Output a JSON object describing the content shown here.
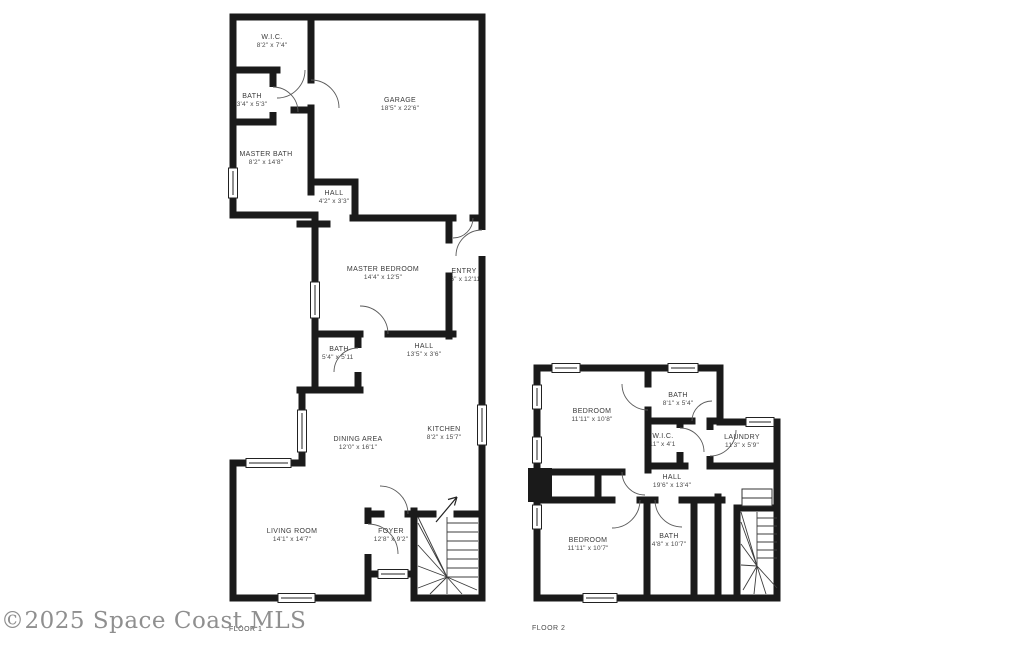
{
  "watermark": "©2025 Space Coast MLS",
  "colors": {
    "wall": "#1a1a1a",
    "label_text": "#3a3a3a",
    "watermark_gray": "#8f8f8f"
  },
  "floors": [
    {
      "label": "FLOOR 1",
      "rooms": [
        {
          "name": "W.I.C.",
          "dims": "8'2\" x 7'4\""
        },
        {
          "name": "BATH",
          "dims": "3'4\" x 5'3\""
        },
        {
          "name": "MASTER BATH",
          "dims": "8'2\" x 14'8\""
        },
        {
          "name": "GARAGE",
          "dims": "18'5\" x 22'6\""
        },
        {
          "name": "HALL",
          "dims": "4'2\" x 3'3\""
        },
        {
          "name": "MASTER BEDROOM",
          "dims": "14'4\" x 12'5\""
        },
        {
          "name": "ENTRY",
          "dims": "3'6\" x 12'11\""
        },
        {
          "name": "BATH",
          "dims": "5'4\" x 5'11\""
        },
        {
          "name": "HALL",
          "dims": "13'5\" x 3'6\""
        },
        {
          "name": "KITCHEN",
          "dims": "8'2\" x 15'7\""
        },
        {
          "name": "DINING AREA",
          "dims": "12'0\" x 16'1\""
        },
        {
          "name": "LIVING ROOM",
          "dims": "14'1\" x 14'7\""
        },
        {
          "name": "FOYER",
          "dims": "12'8\" x 9'2\""
        }
      ]
    },
    {
      "label": "FLOOR 2",
      "rooms": [
        {
          "name": "BEDROOM",
          "dims": "11'11\" x 10'8\""
        },
        {
          "name": "BATH",
          "dims": "8'1\" x 5'4\""
        },
        {
          "name": "W.I.C.",
          "dims": "3'11\" x 4'10\""
        },
        {
          "name": "LAUNDRY",
          "dims": "11'3\" x 5'9\""
        },
        {
          "name": "HALL",
          "dims": "19'6\" x 13'4\""
        },
        {
          "name": "BEDROOM",
          "dims": "11'11\" x 10'7\""
        },
        {
          "name": "BATH",
          "dims": "4'8\" x 10'7\""
        }
      ]
    }
  ]
}
